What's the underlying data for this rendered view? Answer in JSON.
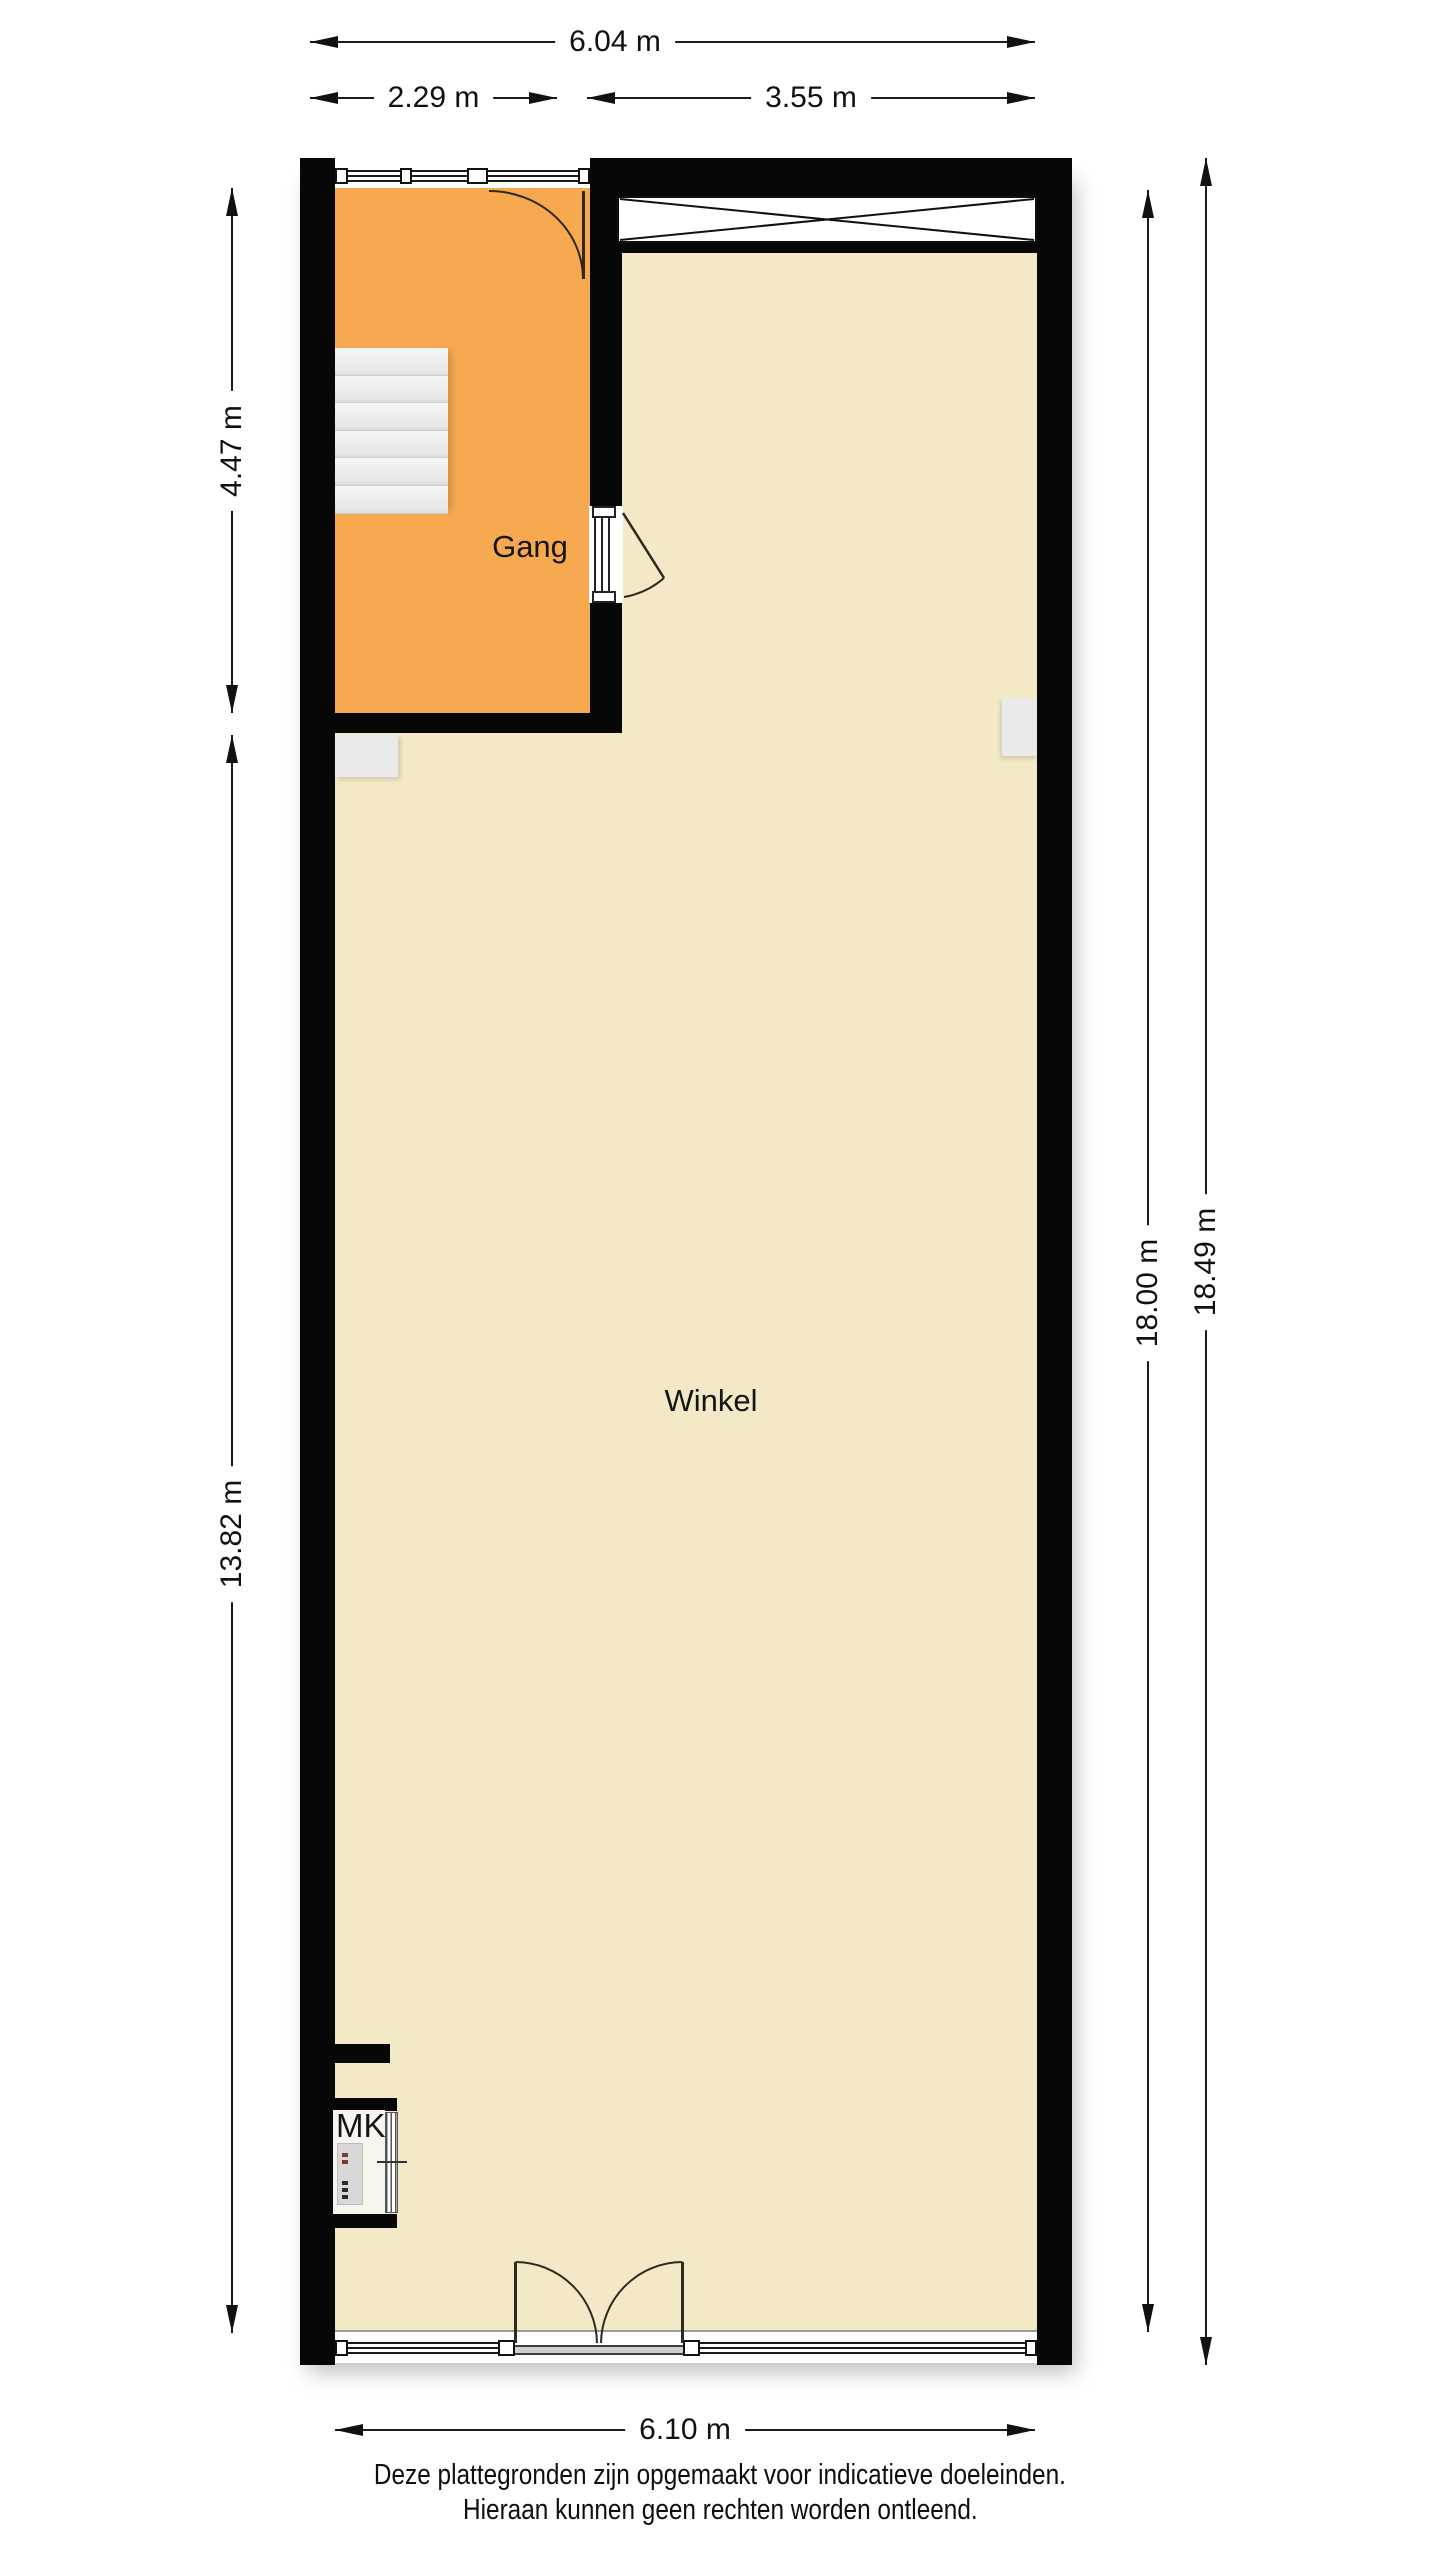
{
  "plan": {
    "title": "floor plan (shop with hallway)",
    "rooms": [
      {
        "id": "gang",
        "label": "Gang",
        "color": "#F6A94F"
      },
      {
        "id": "winkel",
        "label": "Winkel",
        "color": "#F3E9C7"
      },
      {
        "id": "mk",
        "label": "MK",
        "color": "#F8F5EE"
      }
    ],
    "dims": {
      "top_total": "6.04 m",
      "top_left": "2.29 m",
      "top_right": "3.55 m",
      "left_upper": "4.47 m",
      "left_lower": "13.82 m",
      "right_inner": "18.00 m",
      "right_outer": "18.49 m",
      "bottom": "6.10 m"
    },
    "colors": {
      "wall": "#070707",
      "gang_floor": "#F6A94F",
      "winkel_floor": "#F3E9C7",
      "stairs": "#EBEBEB",
      "fixture_gray": "#EAEAEA",
      "dimension_line": "#1C1C1C"
    }
  },
  "footer": {
    "line1": "Deze plattegronden zijn opgemaakt voor indicatieve doeleinden.",
    "line2": "Hieraan kunnen geen rechten worden ontleend."
  }
}
